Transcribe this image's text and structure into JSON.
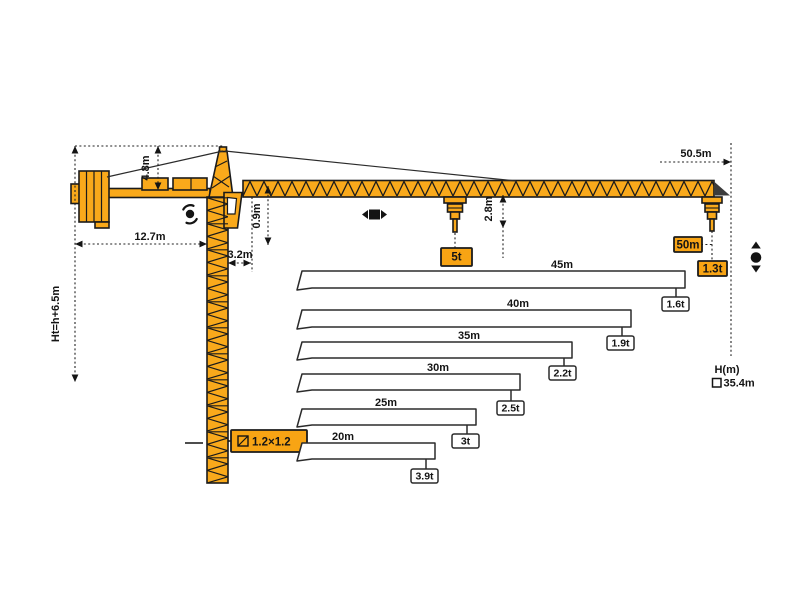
{
  "colors": {
    "crane": "#F9A91B",
    "label_box": "#F8A414",
    "outline": "#1b1b1b",
    "bar_stroke": "#2b2b2b"
  },
  "crane": {
    "dims": {
      "total_height": "Ht=h+6.5m",
      "tower_head_height": "4.8m",
      "counterjib_length": "12.7m",
      "min_radius": "3.2m",
      "jib_depth": "0.9m",
      "hook_clearance": "2.8m",
      "jib_length": "50.5m",
      "mast_section": "1.2×1.2"
    }
  },
  "chart_data": {
    "type": "bar",
    "description": "Tower crane load capacity vs jib radius",
    "entries": [
      {
        "radius": "50m",
        "capacity": "1.3t"
      },
      {
        "radius": "45m",
        "capacity": "1.6t"
      },
      {
        "radius": "40m",
        "capacity": "1.9t"
      },
      {
        "radius": "35m",
        "capacity": "2.2t"
      },
      {
        "radius": "30m",
        "capacity": "2.5t"
      },
      {
        "radius": "25m",
        "capacity": "3t"
      },
      {
        "radius": "20m",
        "capacity": "3.9t"
      }
    ],
    "max_capacity": "5t",
    "height_legend": {
      "label": "H(m)",
      "value": "35.4m"
    }
  }
}
